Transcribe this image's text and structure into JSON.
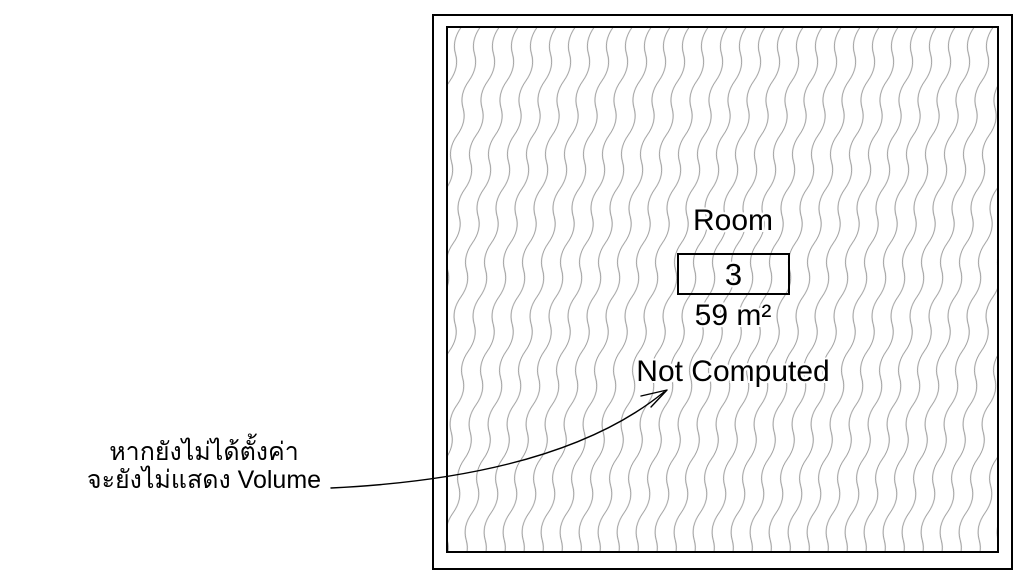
{
  "colors": {
    "background": "#ffffff",
    "drawing_lines": "#000000",
    "hatch_lines": "#9b9b9b",
    "text": "#000000"
  },
  "room_tag": {
    "name": "Room",
    "number": "3",
    "area": "59 m²",
    "volume": "Not Computed"
  },
  "annotation": {
    "line1": "หากยังไม่ได้ตั้งค่า",
    "line2": "จะยังไม่แสดง Volume"
  }
}
